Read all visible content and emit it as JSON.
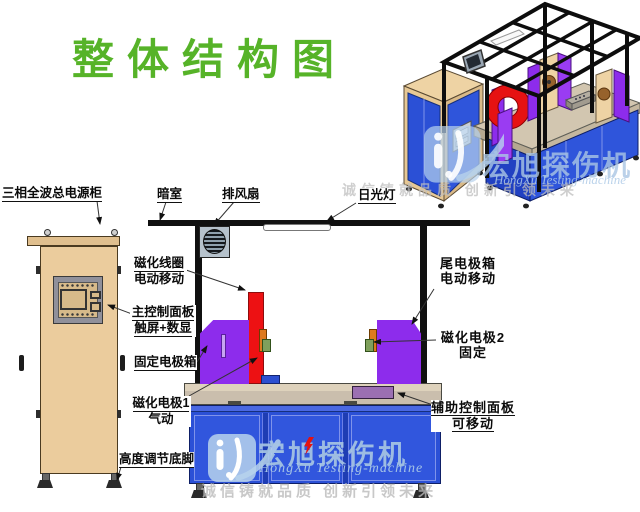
{
  "title": {
    "text": "整体结构图",
    "color": "#56b328"
  },
  "labels": {
    "power_cabinet": "三相全波总电源柜",
    "dark_room": "暗室",
    "exhaust_fan": "排风扇",
    "fluorescent_lamp": "日光灯",
    "magnetizing_coil": {
      "line1": "磁化线圈",
      "line2": "电动移动"
    },
    "main_control_panel": {
      "line1": "主控制面板",
      "line2": "触屏+数显"
    },
    "fixed_electrode_box": "固定电极箱",
    "magnetizing_electrode1": {
      "line1": "磁化电极1",
      "line2": "气动"
    },
    "height_adjustable_feet": "高度调节底脚",
    "tail_electrode_box": {
      "line1": "尾电极箱",
      "line2": "电动移动"
    },
    "magnetizing_electrode2": {
      "line1": "磁化电极2",
      "line2": "固定"
    },
    "auxiliary_control_panel": {
      "line1": "辅助控制面板",
      "line2": "可移动"
    }
  },
  "watermark": {
    "brand_cn": "宏旭探伤机",
    "brand_en": "HongXu Testing-machine",
    "slogan": "诚信铸就品质 创新引领未来"
  },
  "colors": {
    "title_green": "#56b328",
    "machine_blue": "#2b50d6",
    "electrode_purple": "#8d2cec",
    "coil_red": "#ed1113",
    "cabinet_tan": "#ebcc9d",
    "table_tan": "#cabead",
    "electrode_orange": "#dd7a1e",
    "electrode_green": "#7fa05c",
    "frame_black": "#101010",
    "watermark_blue": "#b7d2ec"
  }
}
